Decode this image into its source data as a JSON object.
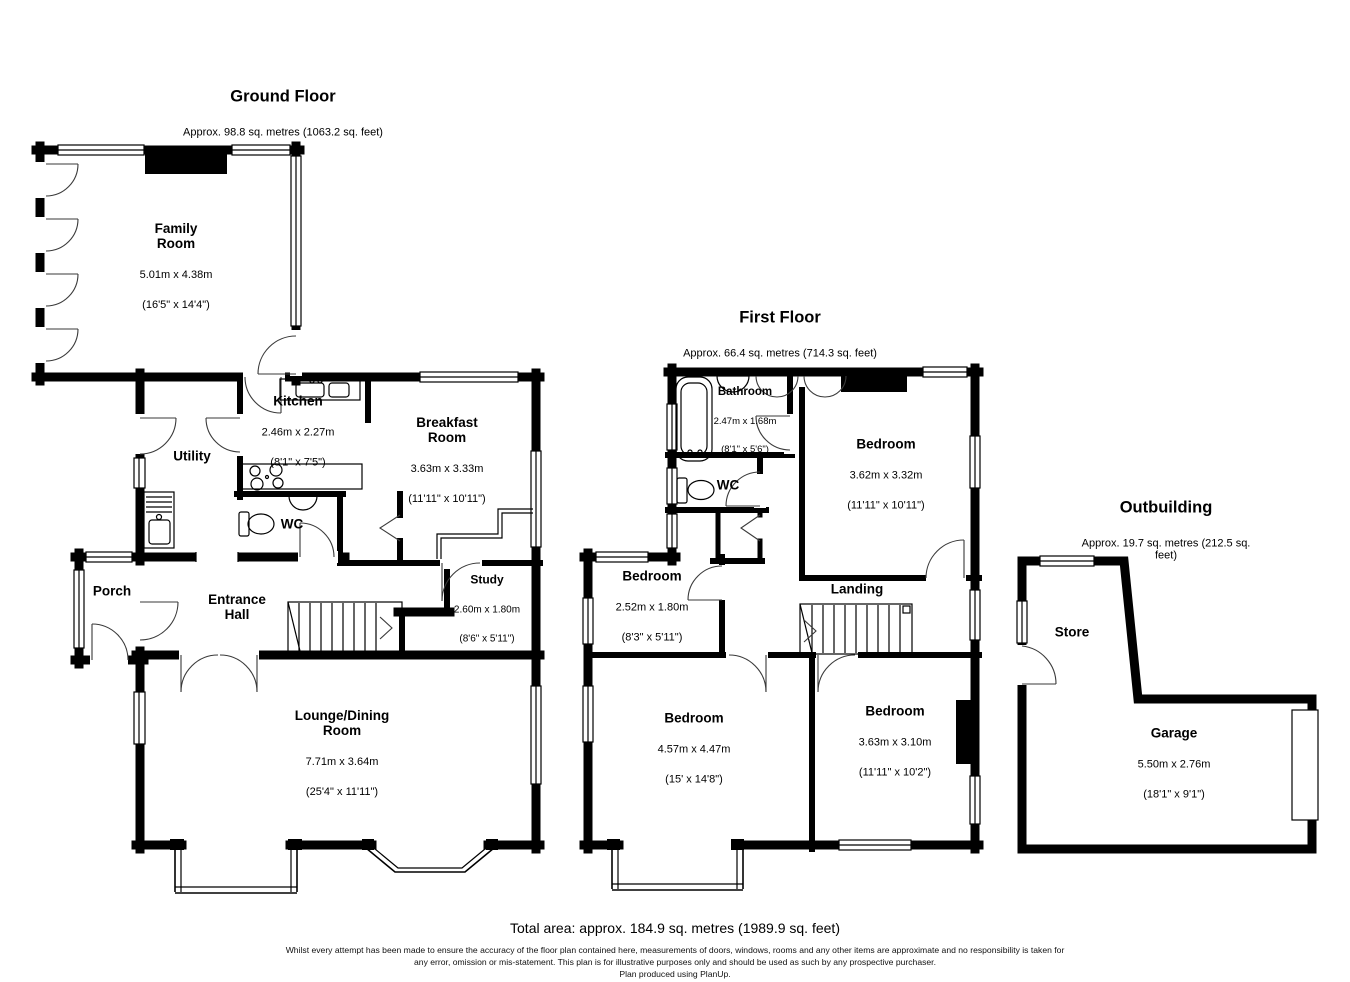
{
  "ground": {
    "title": "Ground Floor",
    "subtitle": "Approx. 98.8 sq. metres (1063.2 sq. feet)",
    "rooms": {
      "family": {
        "name": "Family\nRoom",
        "metric": "5.01m x 4.38m",
        "imperial": "(16'5\" x 14'4\")"
      },
      "kitchen": {
        "name": "Kitchen",
        "metric": "2.46m x 2.27m",
        "imperial": "(8'1\" x 7'5\")"
      },
      "utility": {
        "name": "Utility"
      },
      "breakfast": {
        "name": "Breakfast\nRoom",
        "metric": "3.63m x 3.33m",
        "imperial": "(11'11\" x 10'11\")"
      },
      "wc": {
        "name": "WC"
      },
      "porch": {
        "name": "Porch"
      },
      "entrance_hall": {
        "name": "Entrance\nHall"
      },
      "study": {
        "name": "Study",
        "metric": "2.60m x 1.80m",
        "imperial": "(8'6\" x 5'11\")"
      },
      "lounge": {
        "name": "Lounge/Dining\nRoom",
        "metric": "7.71m x 3.64m",
        "imperial": "(25'4\" x 11'11\")"
      }
    }
  },
  "first": {
    "title": "First Floor",
    "subtitle": "Approx. 66.4 sq. metres (714.3 sq. feet)",
    "rooms": {
      "bathroom": {
        "name": "Bathroom",
        "metric": "2.47m x 1.68m",
        "imperial": "(8'1\" x 5'6\")"
      },
      "wc": {
        "name": "WC"
      },
      "bedroom_top": {
        "name": "Bedroom",
        "metric": "3.62m x 3.32m",
        "imperial": "(11'11\" x 10'11\")"
      },
      "bedroom_mid": {
        "name": "Bedroom",
        "metric": "2.52m x 1.80m",
        "imperial": "(8'3\" x 5'11\")"
      },
      "landing": {
        "name": "Landing"
      },
      "bedroom_bl": {
        "name": "Bedroom",
        "metric": "4.57m x 4.47m",
        "imperial": "(15' x 14'8\")"
      },
      "bedroom_br": {
        "name": "Bedroom",
        "metric": "3.63m x 3.10m",
        "imperial": "(11'11\" x 10'2\")"
      }
    }
  },
  "outbuilding": {
    "title": "Outbuilding",
    "subtitle": "Approx. 19.7 sq. metres (212.5 sq. feet)",
    "rooms": {
      "store": {
        "name": "Store"
      },
      "garage": {
        "name": "Garage",
        "metric": "5.50m x 2.76m",
        "imperial": "(18'1\" x 9'1\")"
      }
    }
  },
  "footer": {
    "total": "Total area: approx. 184.9 sq. metres (1989.9 sq. feet)",
    "disclaimer_line1": "Whilst every attempt has been made to ensure the accuracy of the floor plan contained here, measurements of doors, windows, rooms and any other items are approximate and no responsibility is taken for",
    "disclaimer_line2": "any error, omission or mis-statement. This plan is for illustrative purposes only and should be used as such by any prospective purchaser.",
    "credit": "Plan produced using PlanUp."
  }
}
